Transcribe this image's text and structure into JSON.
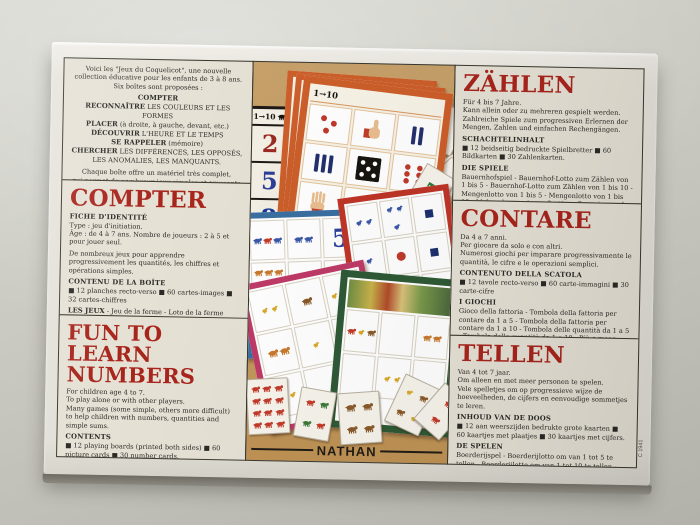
{
  "brand": {
    "name": "NATHAN"
  },
  "box": {
    "side_code": "C 1941"
  },
  "intro": {
    "text": "Voici les \"Jeux du Coquelicot\", une nouvelle\ncollection éducative pour les enfants de 3 à 8 ans.\nSix boîtes sont proposées :",
    "items": [
      {
        "lead": "COMPTER",
        "rest": ""
      },
      {
        "lead": "RECONNAÎTRE",
        "rest": " LES COULEURS ET LES FORMES"
      },
      {
        "lead": "PLACER",
        "rest": " (à droite, à gauche, devant, etc.)"
      },
      {
        "lead": "DÉCOUVRIR",
        "rest": " L'HEURE ET LE TEMPS"
      },
      {
        "lead": "SE RAPPELER",
        "rest": " (mémoire)"
      },
      {
        "lead": "CHERCHER",
        "rest": " LES DIFFÉRENCES, LES OPPOSÉS, LES ANOMALIES, LES MANQUANTS."
      }
    ],
    "outro": "Chaque boîte offre un matériel très complet,\nqui permet de nombreux jeux simples et amusants\nà caractère progressif."
  },
  "panels": {
    "compter": {
      "title": "COMPTER",
      "fiche_label": "FICHE D'IDENTITÉ",
      "fiche_text": "Type : jeu d'initiation.\nÂge : de 4 à 7 ans. Nombre de joueurs : 2 à 5 et pour jouer seul.",
      "desc": "De nombreux jeux pour apprendre progressivement les quantités, les chiffres et opérations simples.",
      "contents_label": "CONTENU DE LA BOÎTE",
      "contents_text": "■ 12 planches recto-verso  ■ 60 cartes-images  ■ 32 cartes-chiffres",
      "games_label": "LES JEUX",
      "games_text": " - Jeu de la ferme - Loto de la ferme pour compter de 1 à 5 - Loto de la ferme pour compter de 1 à 10 - Loto des quantités de 1 à 5 - Loto des quantités de 1 à 10 - Plus ou moins - Jeux de tri, groupement, classement - Bataille - Jeu des familles - Rami."
    },
    "fun": {
      "title_line1": "FUN TO",
      "title_line2": "LEARN NUMBERS",
      "desc": "For children age 4 to 7.\nTo play alone or with other players.\nMany games (some simple, others more difficult) to help children with numbers, quantities and simple sums.",
      "contents_label": "CONTENTS",
      "contents_text": "■ 12 playing boards (printed both sides)  ■ 60 picture cards  ■ 30 number cards.",
      "games_label": "THE GAMES",
      "games_text": "The farm game - Farm lotto (using numbers 1 - 5) - Farm lotto (using numbers 1 - 10) - Quantity lotto (using numbers 1 - 5) - Quantity lotto (using numbers 1 - 10) - Plus or minus.\nOther card games - Beggar my neighbour, happy families, rummy.\nLeaflet in English inside."
    },
    "zahlen": {
      "title": "ZÄHLEN",
      "intro": "Für 4 bis 7 Jahre.\nKann allein oder zu mehreren gespielt werden.\nZahlreiche Spiele zum progressiven Erlernen der Mengen, Zahlen und einfachen Rechengängen.",
      "contents_label": "SCHACHTELINHALT",
      "contents_text": "■ 12 beidseitig bedruckte Spielbretter  ■ 60 Bildkarten  ■ 30 Zahlenkarten.",
      "games_label": "DIE SPIELE",
      "games_text": "Bauernhofspiel - Bauernhof-Lotto zum Zählen von 1 bis 5 - Bauernhof-Lotto zum Zählen von 1 bis 10 - Mengenlotto von 1 bis 5 - Mengenlotto von 1 bis 10 - Mehr oder weniger - Sortier-, Gruppier- und Zuordnungsspiele - Ramschen - Familienspiel - Rommé.",
      "note": "Spielanleitung in Deutsch liegt bei."
    },
    "contare": {
      "title": "CONTARE",
      "intro": "Da 4 a 7 anni.\nPer giocare da solo e con altri.\nNumerosi giochi per imparare progressivamente le quantità, le cifre e le operazioni semplici.",
      "contents_label": "CONTENUTO DELLA SCATOLA",
      "contents_text": "■ 12 tavole recto-verso  ■ 60 carte-immagini  ■ 30 carte-cifre",
      "games_label": "I GIOCHI",
      "games_text": "Gioco della fattoria - Tombola della fattoria per contare da 1 a 5 - Tombola della fattoria per contare da 1 a 10 - Tombola delle quantità da 1 a 5 - Tombola delle quantità da 1 a 10 - Più o meno - Gioco di cernita, raggruppamento, classificazione - Battaglia - Gioco delle famiglie - Ramino.",
      "note": "Istruzioni in italiano all'interno."
    },
    "tellen": {
      "title": "TELLEN",
      "intro": "Van 4 tot 7 jaar.\nOm alleen en met meer personen te spelen.\nVele spelletjes om op progressieve wijze de hoeveelheden, de cijfers en eenvoudige sommetjes te leren.",
      "contents_label": "INHOUD VAN DE DOOS",
      "contents_text": "■ 12 aan weerszijden bedrukte grote kaarten  ■ 60 kaartjes met plaatjes  ■ 30 kaartjes met cijfers.",
      "games_label": "DE SPELEN",
      "games_text": "Boerderijspel - Boerderijlotto om van 1 tot 5 te tellen - Boerderijlotto om van 1 tot 10 te tellen - Lotto met hoeveelheden van 1 tot 5 - Lotto met hoeveelheden van 1 tot 10 - Meer of minder - Zoek-, groepeer- en sorteerspel - Bataille - Kwartetspel - Ramispel.",
      "note": "Nederlandse handleiding in de doos."
    }
  },
  "photo": {
    "black_board": {
      "header": "1→10",
      "numbers": [
        "2",
        "5",
        "8",
        "3",
        "6",
        "9"
      ]
    },
    "orange_board": {
      "header": "1→10",
      "ten": "10"
    },
    "cards": {
      "eight": "8",
      "ten": "10",
      "seven": "7",
      "two": "2",
      "range": "1→5"
    },
    "blue_board": {
      "number": "5"
    },
    "red_board": {
      "number": "3"
    }
  },
  "colors": {
    "heading_red": "#a8251c",
    "tan_photo": "#c39a60",
    "orange_frame": "#cd5f2a",
    "blue_frame": "#3a6fa0",
    "red_frame": "#bf3527",
    "pink_frame": "#bf3a67",
    "green_frame": "#2f5a36"
  }
}
